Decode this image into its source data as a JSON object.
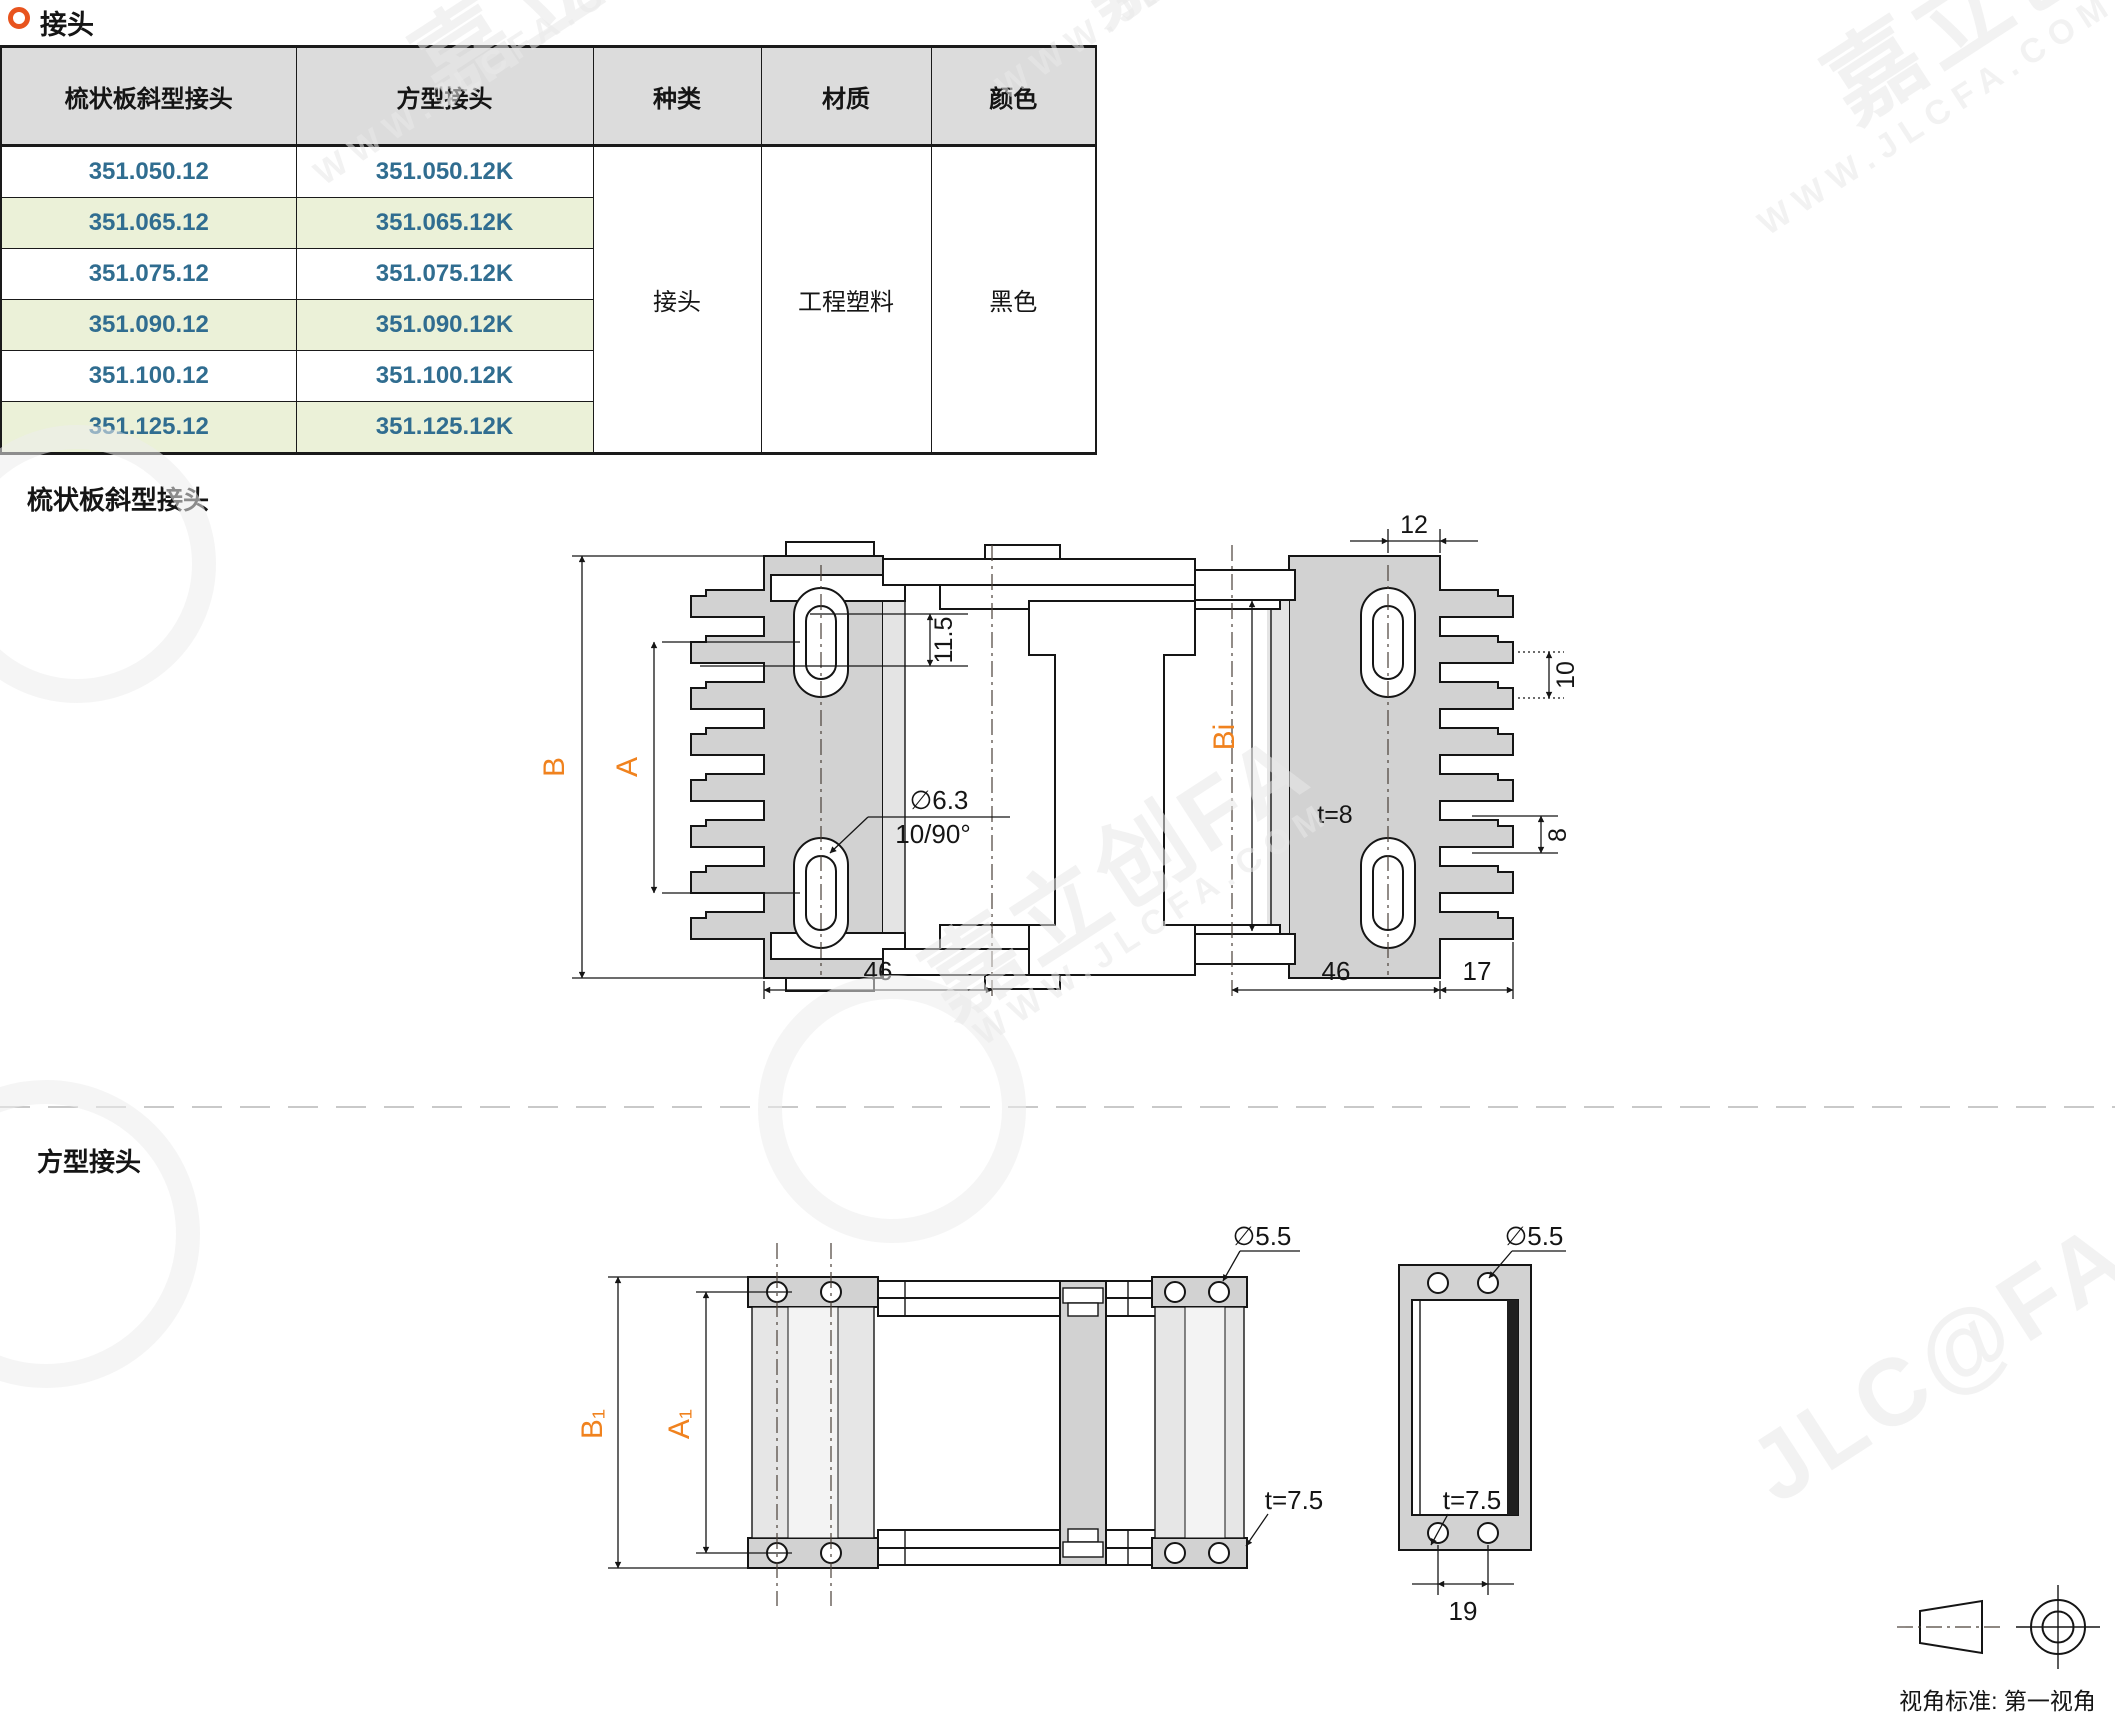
{
  "header": {
    "title": "接头"
  },
  "table": {
    "headers": [
      "梳状板斜型接头",
      "方型接头",
      "种类",
      "材质",
      "颜色"
    ],
    "rows": [
      [
        "351.050.12",
        "351.050.12K"
      ],
      [
        "351.065.12",
        "351.065.12K"
      ],
      [
        "351.075.12",
        "351.075.12K"
      ],
      [
        "351.090.12",
        "351.090.12K"
      ],
      [
        "351.100.12",
        "351.100.12K"
      ],
      [
        "351.125.12",
        "351.125.12K"
      ]
    ],
    "merged": {
      "type": "接头",
      "material": "工程塑料",
      "color": "黑色"
    }
  },
  "sections": {
    "s1": "梳状板斜型接头",
    "s2": "方型接头"
  },
  "drawing1": {
    "B": "B",
    "A": "A",
    "Bi": "Bi",
    "d11_5": "11.5",
    "d12": "12",
    "d10": "10",
    "d8": "8",
    "t": "t=8",
    "hole": "∅6.3",
    "slot": "10/90°",
    "w46l": "46",
    "w46r": "46",
    "d17": "17"
  },
  "drawing2": {
    "B1": "B₁",
    "A1": "A₁",
    "hole1": "∅5.5",
    "hole2": "∅5.5",
    "t1": "t=7.5",
    "t2": "t=7.5",
    "d19": "19"
  },
  "watermark": {
    "brand": "JLC@FA",
    "brand_cn": "嘉立创FA",
    "url": "WWW.JLCFA.COM"
  },
  "footer": {
    "view_standard": "视角标准: 第一视角"
  },
  "colors": {
    "accent_orange": "#f0821e",
    "bullet_orange": "#e8541e",
    "part_blue": "#306d90",
    "row_green": "#ebf1d8",
    "header_gray": "#dcdcdc",
    "line": "#151515"
  }
}
